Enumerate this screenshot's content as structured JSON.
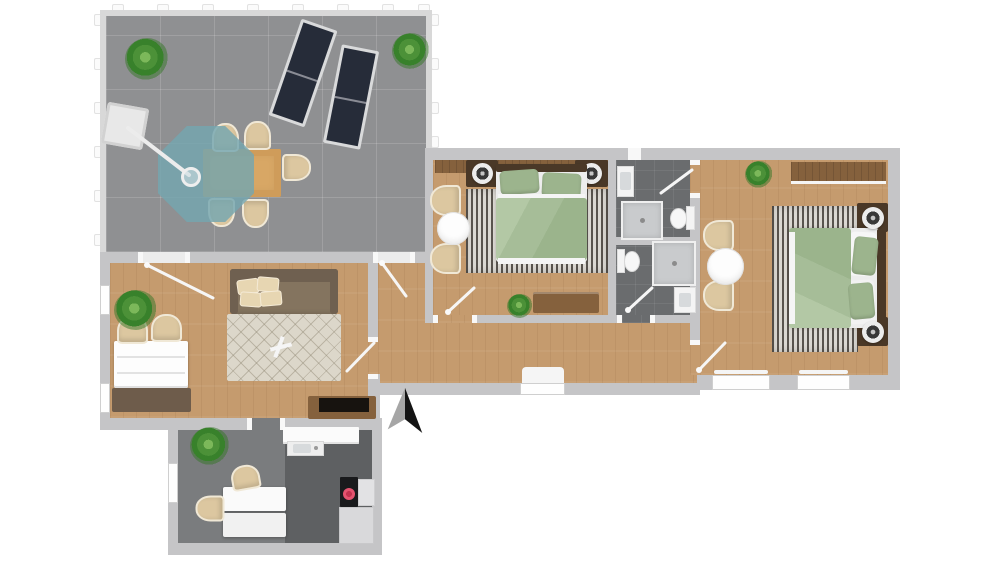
{
  "meta": {
    "title": "3D floor plan — top-down rendering",
    "view": "top-down architectural rendering, no text labels"
  },
  "compass": {
    "visible": true,
    "pointing": "up",
    "style": "half gray / half black arrow"
  },
  "colors": {
    "wall": "#c5c5c7",
    "fence": "#d8d8d8",
    "terrace": "#8f9092",
    "wood": "#c59b6e",
    "bath": "#6a6c6e",
    "office": "#7a7c7e",
    "kitchen": "#5e6062",
    "green2": "#9cb48d",
    "mattress": "#ededed",
    "beige": "#dcc7a0",
    "sofa": "#84745f",
    "sofaback": "#6f6050",
    "pillow": "#e7d6b2",
    "cream": "#dcd7ca",
    "stripe": "#59544e",
    "stripe2": "#dbd8d2",
    "teal": "#74a6b0",
    "lounger": "#262c39",
    "tan": "#d8a765",
    "darkwood": "#4a3827",
    "woodfurn": "#85613d",
    "stovered": "#e4536f",
    "counter": "#d9d9db",
    "mat": "#6e5c4b",
    "arrowgray": "#a6a6a6",
    "arrowdark": "#141414",
    "plantgreen": "#4c9138"
  },
  "rooms": [
    {
      "name": "terrace",
      "floor": "concrete-tiles",
      "furniture": [
        "sun-lounger",
        "sun-lounger",
        "outdoor-dining-table",
        "dining-chair",
        "dining-chair",
        "dining-chair",
        "dining-chair",
        "dining-chair",
        "parasol",
        "parasol-base",
        "potted-plant",
        "potted-plant"
      ]
    },
    {
      "name": "living-room",
      "floor": "wood",
      "furniture": [
        "sofa",
        "sofa-cushions",
        "diamond-pattern-rug",
        "tv-console",
        "white-desk",
        "desk-chair",
        "desk-chair",
        "potted-plant",
        "dark-mat"
      ]
    },
    {
      "name": "hallway",
      "floor": "wood",
      "furniture": [
        "window-sill"
      ]
    },
    {
      "name": "bedroom-1",
      "floor": "wood",
      "furniture": [
        "double-bed-green",
        "headboard-panel",
        "nightstand",
        "nightstand",
        "table-lamp",
        "table-lamp",
        "striped-rug",
        "armchair",
        "armchair",
        "round-side-table",
        "wooden-bench",
        "potted-plant"
      ]
    },
    {
      "name": "bathroom-top",
      "floor": "dark-tile",
      "furniture": [
        "vanity-sink",
        "shower",
        "toilet"
      ]
    },
    {
      "name": "bathroom-bottom",
      "floor": "dark-tile",
      "furniture": [
        "toilet",
        "shower",
        "vanity-sink"
      ]
    },
    {
      "name": "bedroom-2",
      "floor": "wood",
      "furniture": [
        "double-bed-green",
        "sideboard",
        "nightstand",
        "nightstand",
        "table-lamp",
        "table-lamp",
        "striped-rug",
        "armchair",
        "armchair",
        "round-side-table",
        "potted-plant"
      ]
    },
    {
      "name": "office-kitchen",
      "floor": "dark-tile",
      "furniture": [
        "white-desk",
        "office-chair",
        "office-chair",
        "potted-plant",
        "kitchen-counter",
        "kitchen-sink",
        "cooktop-red-burner",
        "cabinet",
        "cabinet"
      ]
    }
  ],
  "doors": [
    "terrace-to-living",
    "terrace-to-hall",
    "living-to-hall",
    "corridor-to-bedroom-1",
    "corridor-to-bathroom-bottom",
    "bedroom-2-to-bathroom-top",
    "corridor-to-bedroom-2",
    "living-to-office-kitchen"
  ],
  "windows": [
    "living-left-upper",
    "living-left-lower",
    "corridor-south",
    "bedroom-2-south-left",
    "bedroom-2-south-right",
    "office-left"
  ]
}
